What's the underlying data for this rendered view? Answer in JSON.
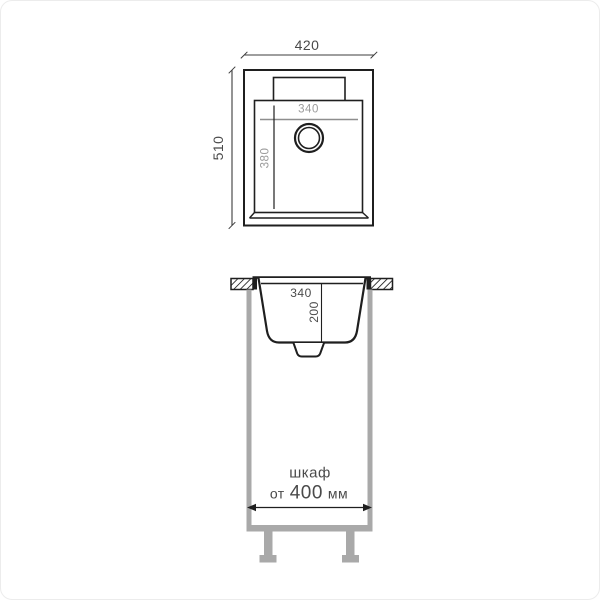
{
  "top_view": {
    "overall_width_mm": "420",
    "overall_depth_mm": "510",
    "bowl_width_mm": "340",
    "bowl_depth_mm": "380"
  },
  "section_view": {
    "bowl_width_mm": "340",
    "bowl_height_mm": "200"
  },
  "cabinet": {
    "label": "шкаф",
    "from_word": "от",
    "min_width_value": "400",
    "unit": "мм"
  },
  "colors": {
    "line": "#1f1f1f",
    "dim_line_dark": "#3c3c3c",
    "dim_line_gray": "#8e8e8e",
    "text_gray": "#9b9b9b",
    "text_dark": "#4a4a4a",
    "cabinet_gray": "#a9a9a9",
    "bg": "#ffffff",
    "frame": "#ececec"
  }
}
